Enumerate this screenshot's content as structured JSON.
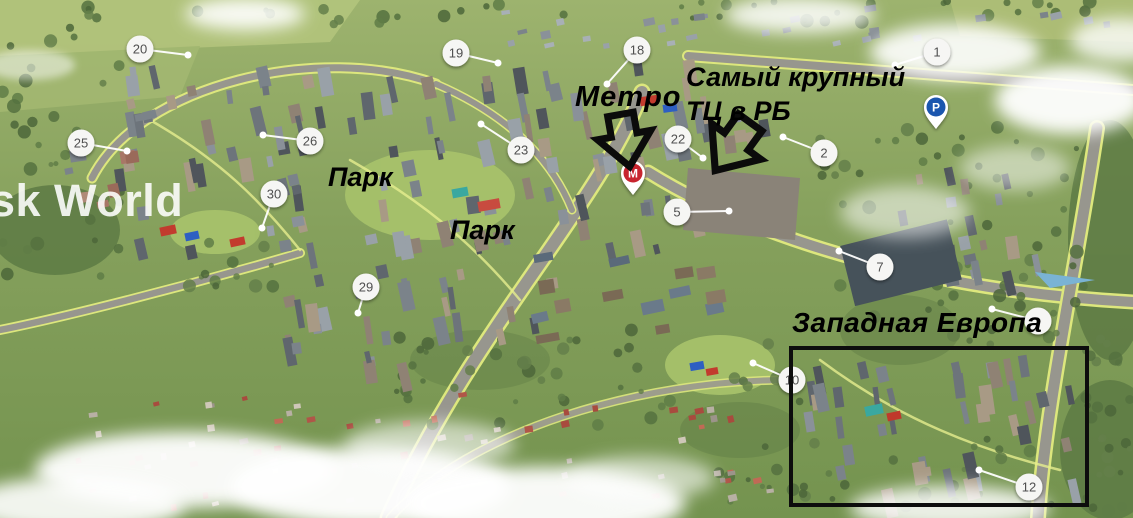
{
  "map": {
    "watermark_text": "sk World",
    "annotations": {
      "metro_label": "Метро",
      "mall_label_line1": "Самый крупный",
      "mall_label_line2": "ТЦ в РБ",
      "park_label_1": "Парк",
      "park_label_2": "Парк",
      "western_europe_label": "Западная Европа"
    },
    "colors": {
      "metro_pin": "#c8252f",
      "parking_pin": "#1b56ae",
      "marker_fill": "#f6f6f4",
      "marker_text": "#4f4f4f",
      "annotation_text": "#000000",
      "highlight_box": "#0d0d0d",
      "leader_line": "#ffffff",
      "watermark": "#ffffff"
    },
    "markers": [
      {
        "label": "20",
        "x": 140,
        "y": 49,
        "dx": 188,
        "dy": 55
      },
      {
        "label": "19",
        "x": 456,
        "y": 53,
        "dx": 498,
        "dy": 63
      },
      {
        "label": "18",
        "x": 637,
        "y": 50,
        "dx": 607,
        "dy": 84
      },
      {
        "label": "1",
        "x": 937,
        "y": 52,
        "dx": 895,
        "dy": 65
      },
      {
        "label": "25",
        "x": 81,
        "y": 143,
        "dx": 127,
        "dy": 151
      },
      {
        "label": "26",
        "x": 310,
        "y": 141,
        "dx": 263,
        "dy": 135
      },
      {
        "label": "23",
        "x": 521,
        "y": 150,
        "dx": 481,
        "dy": 124
      },
      {
        "label": "22",
        "x": 678,
        "y": 139,
        "dx": 703,
        "dy": 158
      },
      {
        "label": "2",
        "x": 824,
        "y": 153,
        "dx": 783,
        "dy": 137
      },
      {
        "label": "30",
        "x": 274,
        "y": 194,
        "dx": 262,
        "dy": 228
      },
      {
        "label": "5",
        "x": 677,
        "y": 212,
        "dx": 729,
        "dy": 211
      },
      {
        "label": "7",
        "x": 880,
        "y": 267,
        "dx": 839,
        "dy": 251
      },
      {
        "label": "29",
        "x": 366,
        "y": 287,
        "dx": 358,
        "dy": 313
      },
      {
        "label": "",
        "x": 1038,
        "y": 321,
        "dx": 992,
        "dy": 309
      },
      {
        "label": "10",
        "x": 792,
        "y": 380,
        "dx": 753,
        "dy": 363
      },
      {
        "label": "12",
        "x": 1029,
        "y": 487,
        "dx": 979,
        "dy": 470
      }
    ],
    "pins": [
      {
        "kind": "metro",
        "letter": "М",
        "x": 633,
        "y": 174
      },
      {
        "kind": "parking",
        "letter": "P",
        "x": 936,
        "y": 108
      }
    ]
  }
}
